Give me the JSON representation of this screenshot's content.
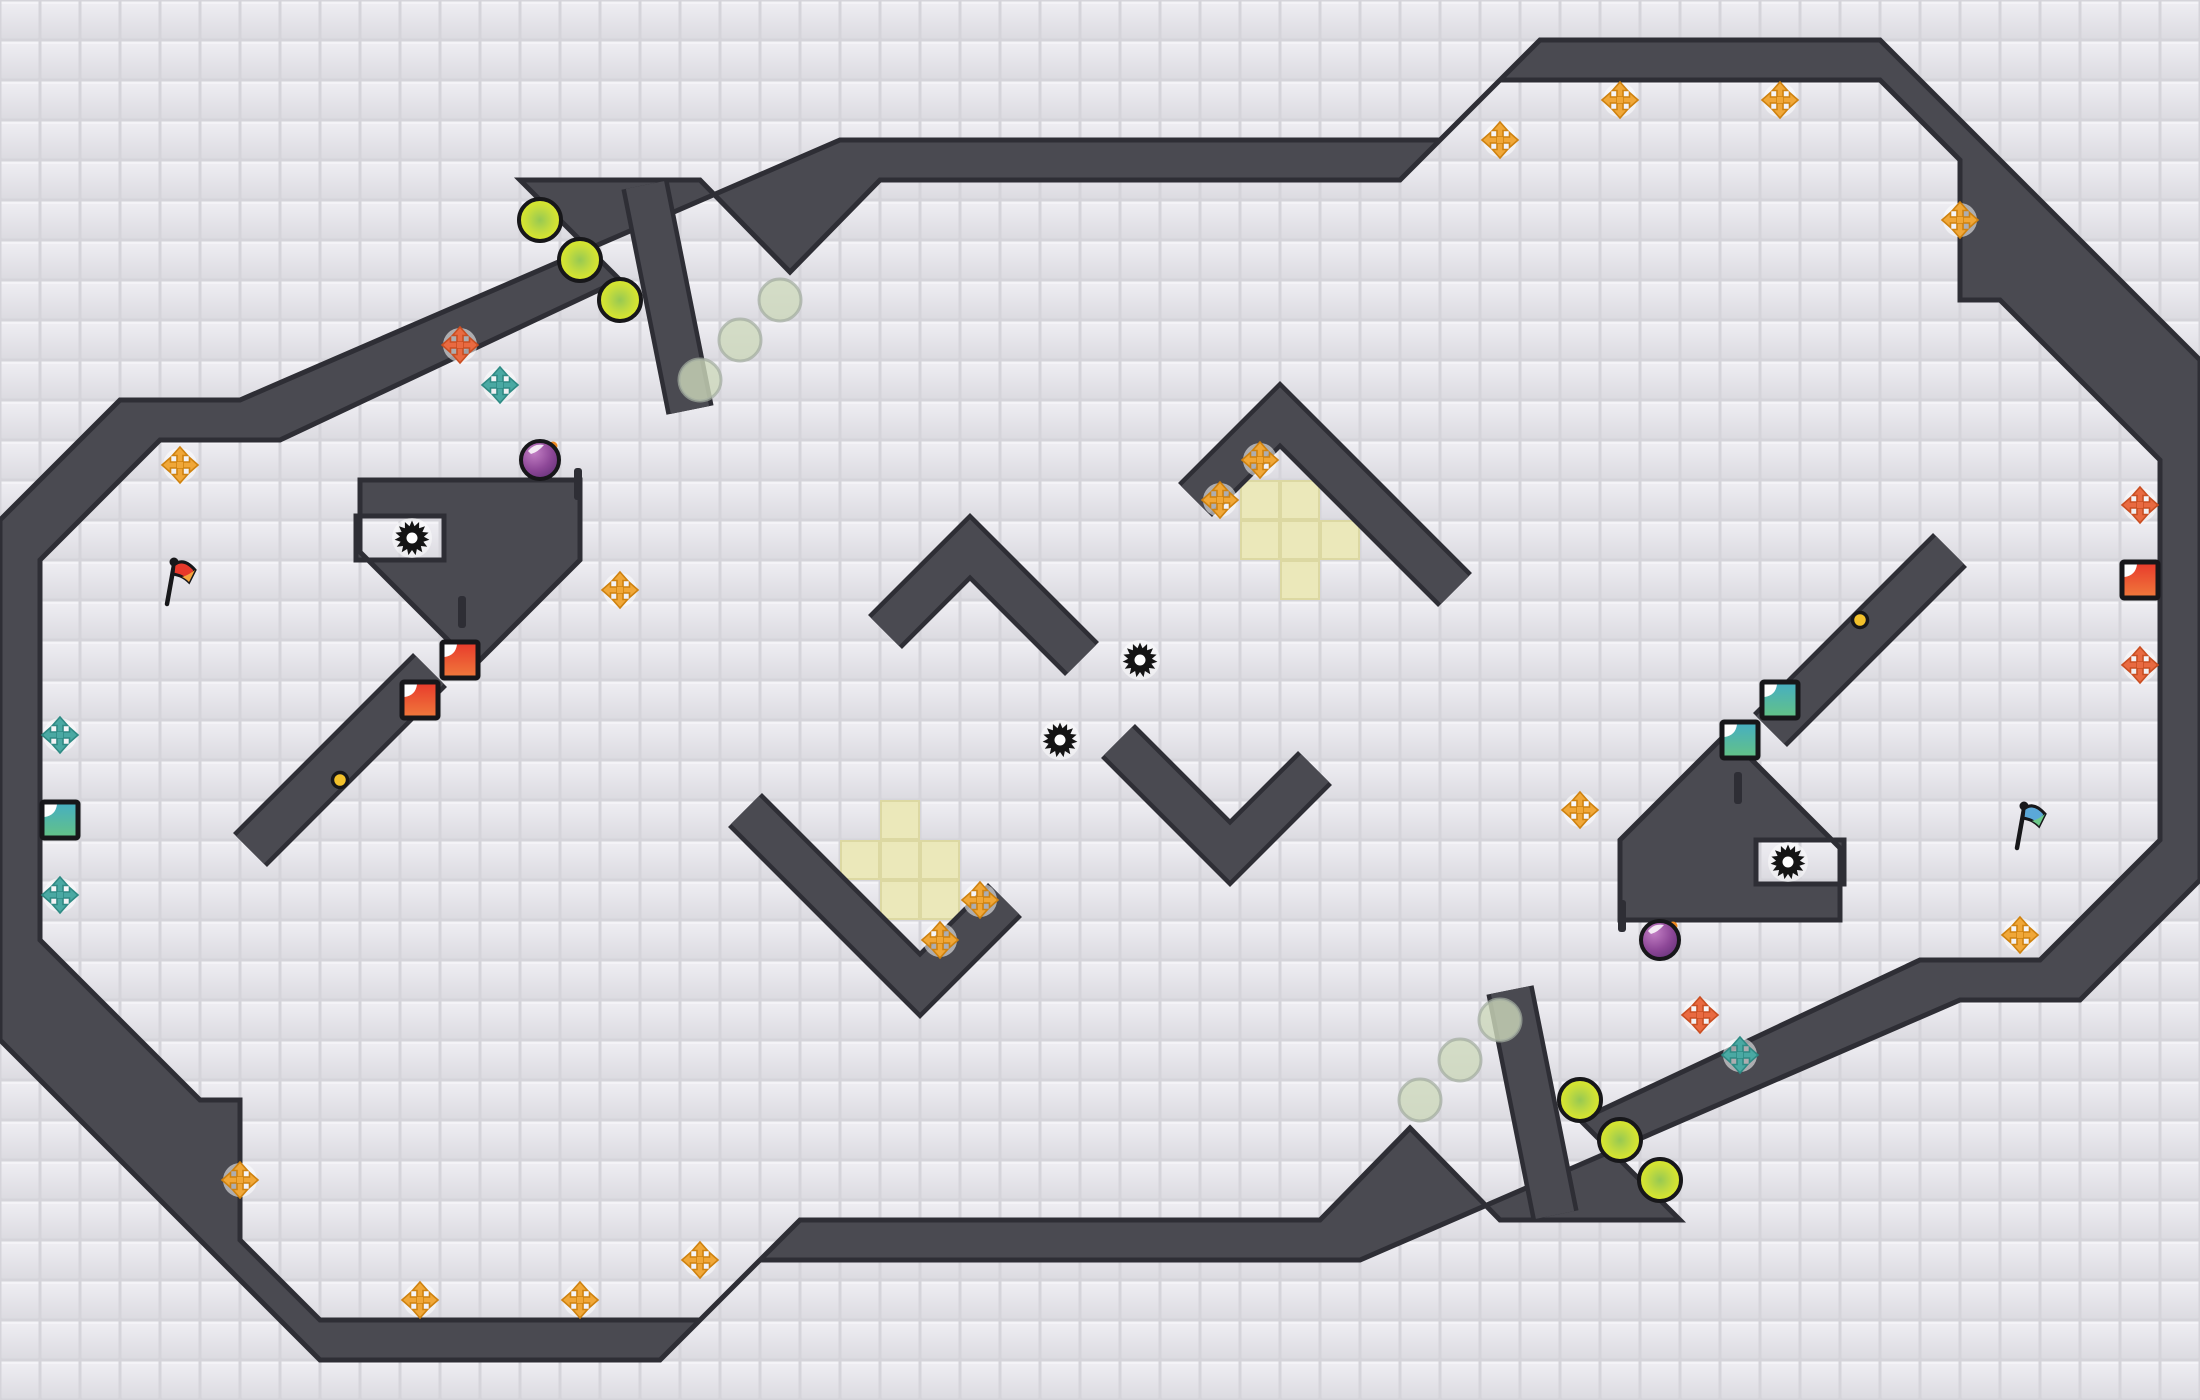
{
  "map": {
    "width": 2200,
    "height": 1400,
    "tile_size": 40,
    "colors": {
      "floor": "#e7e6eb",
      "floor_shade": "#dcdbe1",
      "grout": "#d5d4da",
      "wall": "#4a4a51",
      "wall_edge": "#2e2e35",
      "highlight_tile": "#ebe8ba",
      "highlight_edge": "#dcd8a2",
      "gold": "#f0a738",
      "gold_dark": "#cf820f",
      "orange": "#e96a41",
      "orange_dark": "#c94e22",
      "teal": "#4aa9a3",
      "teal_dark": "#2f8a84",
      "orb_rim": "#e3ec24",
      "orb_core": "#97c952",
      "ghost_fill": "#cdd8bc",
      "ghost_rim": "#a3ad9f",
      "bomb_light": "#c27ec4",
      "bomb_dark": "#5f2e74",
      "bomb_spark": "#f0881e",
      "mine": "#141414",
      "red_square_a": "#e8392b",
      "red_square_b": "#f07a3c",
      "teal_square_a": "#45aec4",
      "teal_square_b": "#64c285",
      "flag_red": "#e8392b",
      "flag_red_tip": "#f5a33b",
      "flag_blue": "#5ba8d8",
      "flag_blue_tip": "#6cc98a",
      "gold_dot": "#f3c12b",
      "outline": "#17171a"
    },
    "walls": {
      "border_outer": [
        [
          120,
          400
        ],
        [
          240,
          400
        ],
        [
          840,
          140
        ],
        [
          1440,
          140
        ],
        [
          1540,
          40
        ],
        [
          1880,
          40
        ],
        [
          2200,
          360
        ],
        [
          2200,
          880
        ],
        [
          2080,
          1000
        ],
        [
          1960,
          1000
        ],
        [
          1360,
          1260
        ],
        [
          760,
          1260
        ],
        [
          660,
          1360
        ],
        [
          320,
          1360
        ],
        [
          0,
          1040
        ],
        [
          0,
          520
        ]
      ],
      "border_inner": [
        [
          160,
          440
        ],
        [
          280,
          440
        ],
        [
          620,
          280
        ],
        [
          520,
          180
        ],
        [
          700,
          180
        ],
        [
          790,
          272
        ],
        [
          880,
          180
        ],
        [
          1400,
          180
        ],
        [
          1500,
          80
        ],
        [
          1880,
          80
        ],
        [
          1960,
          160
        ],
        [
          1960,
          300
        ],
        [
          2000,
          300
        ],
        [
          2160,
          460
        ],
        [
          2160,
          840
        ],
        [
          2040,
          960
        ],
        [
          1920,
          960
        ],
        [
          1580,
          1120
        ],
        [
          1680,
          1220
        ],
        [
          1500,
          1220
        ],
        [
          1410,
          1128
        ],
        [
          1320,
          1220
        ],
        [
          800,
          1220
        ],
        [
          700,
          1320
        ],
        [
          320,
          1320
        ],
        [
          240,
          1240
        ],
        [
          240,
          1100
        ],
        [
          200,
          1100
        ],
        [
          40,
          940
        ],
        [
          40,
          560
        ]
      ],
      "bands": [
        [
          [
            645,
            185
          ],
          [
            690,
            410
          ]
        ],
        [
          [
            1555,
            1215
          ],
          [
            1510,
            990
          ]
        ],
        [
          [
            250,
            850
          ],
          [
            430,
            670
          ]
        ],
        [
          [
            1950,
            550
          ],
          [
            1770,
            730
          ]
        ],
        [
          [
            885,
            632
          ],
          [
            970,
            547
          ],
          [
            1082,
            659
          ]
        ],
        [
          [
            1315,
            768
          ],
          [
            1230,
            853
          ],
          [
            1118,
            741
          ]
        ],
        [
          [
            745,
            810
          ],
          [
            920,
            985
          ],
          [
            1005,
            900
          ]
        ],
        [
          [
            1455,
            590
          ],
          [
            1280,
            415
          ],
          [
            1195,
            500
          ]
        ]
      ],
      "chevron_blocks": [
        "M360,480 L580,480 L580,560 L474,666 L360,552 Z M356,516 L444,516 L444,560 L356,560 Z",
        "M1840,920 L1620,920 L1620,840 L1726,734 L1840,848 Z M1844,884 L1756,884 L1756,840 L1844,840 Z"
      ],
      "door_ticks": [
        [
          574,
          468
        ],
        [
          458,
          596
        ],
        [
          1618,
          900
        ],
        [
          1734,
          772
        ]
      ]
    },
    "highlight_tiles": [
      [
        880,
        800
      ],
      [
        840,
        840
      ],
      [
        880,
        840
      ],
      [
        920,
        840
      ],
      [
        880,
        880
      ],
      [
        920,
        880
      ],
      [
        1240,
        480
      ],
      [
        1280,
        480
      ],
      [
        1240,
        520
      ],
      [
        1280,
        520
      ],
      [
        1320,
        520
      ],
      [
        1280,
        560
      ]
    ],
    "entities": {
      "gold_arrows": [
        [
          1500,
          140
        ],
        [
          1620,
          100
        ],
        [
          1780,
          100
        ],
        [
          1960,
          220
        ],
        [
          180,
          465
        ],
        [
          620,
          590
        ],
        [
          940,
          940
        ],
        [
          980,
          900
        ],
        [
          1220,
          500
        ],
        [
          1260,
          460
        ],
        [
          1580,
          810
        ],
        [
          2020,
          935
        ],
        [
          240,
          1180
        ],
        [
          420,
          1300
        ],
        [
          580,
          1300
        ],
        [
          700,
          1260
        ]
      ],
      "orange_arrows": [
        [
          460,
          345
        ],
        [
          1700,
          1015
        ],
        [
          2140,
          505
        ],
        [
          2140,
          665
        ]
      ],
      "teal_arrows": [
        [
          500,
          385
        ],
        [
          1740,
          1055
        ],
        [
          60,
          735
        ],
        [
          60,
          895
        ]
      ],
      "green_orbs": [
        [
          540,
          220
        ],
        [
          580,
          260
        ],
        [
          620,
          300
        ],
        [
          1660,
          1180
        ],
        [
          1620,
          1140
        ],
        [
          1580,
          1100
        ]
      ],
      "ghost_orbs": [
        [
          780,
          300
        ],
        [
          740,
          340
        ],
        [
          700,
          380
        ],
        [
          1420,
          1100
        ],
        [
          1460,
          1060
        ],
        [
          1500,
          1020
        ]
      ],
      "bombs": [
        [
          540,
          460
        ],
        [
          1660,
          940
        ]
      ],
      "mines": [
        [
          412,
          538
        ],
        [
          1788,
          862
        ],
        [
          1140,
          660
        ],
        [
          1060,
          740
        ]
      ],
      "red_squares": [
        [
          460,
          660
        ],
        [
          420,
          700
        ],
        [
          2140,
          580
        ]
      ],
      "teal_squares": [
        [
          1780,
          700
        ],
        [
          1740,
          740
        ],
        [
          60,
          820
        ]
      ],
      "gold_dots": [
        [
          340,
          780
        ],
        [
          1860,
          620
        ]
      ],
      "flags": [
        {
          "x": 175,
          "y": 578,
          "color": "red"
        },
        {
          "x": 2025,
          "y": 822,
          "color": "blue"
        }
      ]
    }
  }
}
